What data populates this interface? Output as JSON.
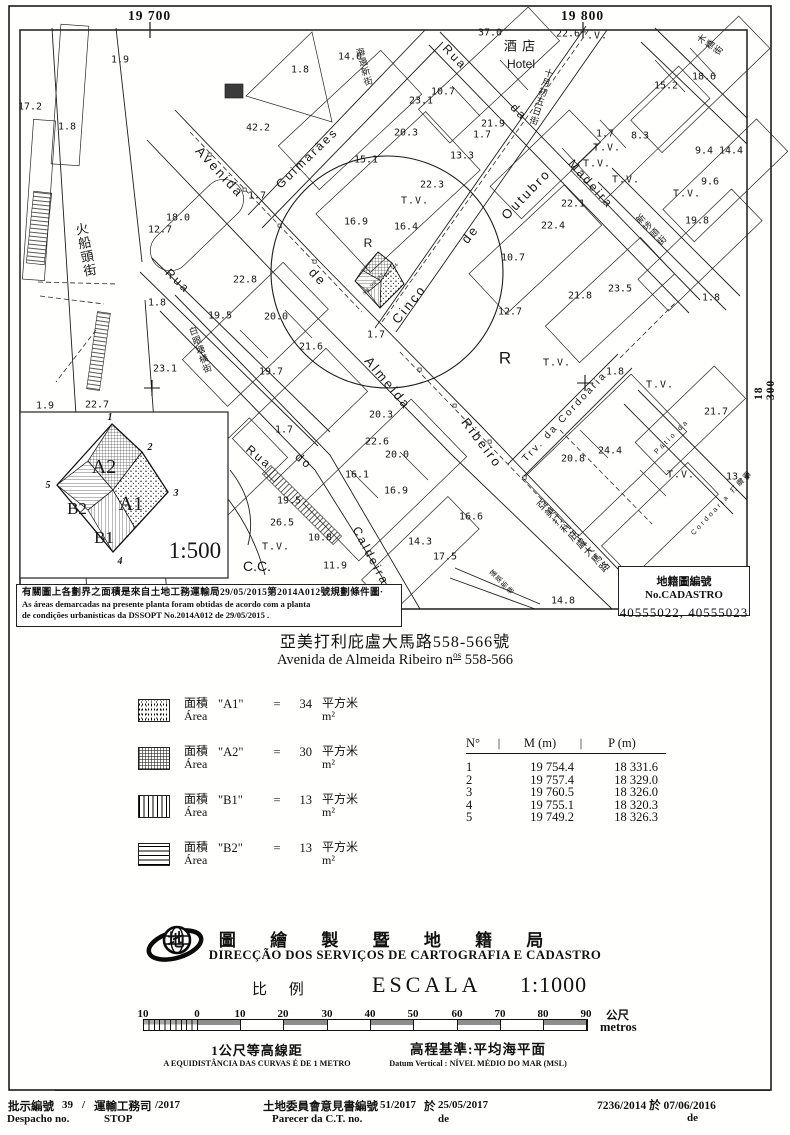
{
  "grid": {
    "top_left": "19 700",
    "top_right": "19 800",
    "right": "18 300"
  },
  "map": {
    "labels": [
      {
        "t": "Avenida",
        "x": 220,
        "y": 172,
        "r": 47,
        "s": 13,
        "k": "street"
      },
      {
        "t": "de",
        "x": 318,
        "y": 277,
        "r": 47,
        "s": 13,
        "k": "street"
      },
      {
        "t": "Almeida",
        "x": 388,
        "y": 383,
        "r": 50,
        "s": 13,
        "k": "street"
      },
      {
        "t": "Ribeiro",
        "x": 482,
        "y": 443,
        "r": 53,
        "s": 13,
        "k": "street"
      },
      {
        "t": "Cinco",
        "x": 409,
        "y": 304,
        "r": -51,
        "s": 13,
        "k": "street"
      },
      {
        "t": "de",
        "x": 470,
        "y": 234,
        "r": -51,
        "s": 13,
        "k": "street"
      },
      {
        "t": "Outubro",
        "x": 526,
        "y": 194,
        "r": -46,
        "s": 13,
        "k": "street"
      },
      {
        "t": "Guimarães",
        "x": 307,
        "y": 158,
        "r": -44,
        "s": 12,
        "k": "street"
      },
      {
        "t": "Rua",
        "x": 455,
        "y": 57,
        "r": 46,
        "s": 12,
        "k": "street"
      },
      {
        "t": "da",
        "x": 519,
        "y": 112,
        "r": 46,
        "s": 12,
        "k": "street"
      },
      {
        "t": "Madeira",
        "x": 591,
        "y": 184,
        "r": 48,
        "s": 12,
        "k": "street"
      },
      {
        "t": "Rua",
        "x": 178,
        "y": 281,
        "r": 44,
        "s": 12,
        "k": "street"
      },
      {
        "t": "Rua",
        "x": 259,
        "y": 457,
        "r": 40,
        "s": 12,
        "k": "street"
      },
      {
        "t": "do",
        "x": 304,
        "y": 461,
        "r": 40,
        "s": 12,
        "k": "street"
      },
      {
        "t": "Caldeira",
        "x": 371,
        "y": 556,
        "r": 62,
        "s": 12,
        "k": "street"
      },
      {
        "t": "Trv. da Cordoaria",
        "x": 565,
        "y": 417,
        "r": -47,
        "s": 10,
        "k": "street"
      },
      {
        "t": "Pátio da",
        "x": 672,
        "y": 437,
        "r": -45,
        "s": 7,
        "k": "street"
      },
      {
        "t": "Cordoaria 打纜圍",
        "x": 722,
        "y": 503,
        "r": -47,
        "s": 7,
        "k": "street"
      },
      {
        "t": "Hotel",
        "x": 521,
        "y": 64,
        "r": 0,
        "s": 12,
        "k": "letter"
      },
      {
        "t": "酒 店",
        "x": 520,
        "y": 46,
        "r": 0,
        "s": 13,
        "k": "cjkh"
      },
      {
        "t": "火船頭街",
        "x": 85,
        "y": 250,
        "r": -11,
        "s": 13,
        "k": "cjk",
        "v": 1
      },
      {
        "t": "海邊新街",
        "x": 364,
        "y": 67,
        "r": -15,
        "s": 9,
        "k": "cjk",
        "v": 1
      },
      {
        "t": "十月初五日街",
        "x": 541,
        "y": 97,
        "r": 17,
        "s": 9,
        "k": "cjk",
        "v": 1
      },
      {
        "t": "木橋街",
        "x": 710,
        "y": 45,
        "r": -55,
        "s": 9,
        "k": "cjk",
        "v": 1
      },
      {
        "t": "新埗頭街",
        "x": 651,
        "y": 230,
        "r": -44,
        "s": 9,
        "k": "cjk",
        "v": 1
      },
      {
        "t": "白眼塘橫街",
        "x": 200,
        "y": 350,
        "r": -20,
        "s": 9,
        "k": "cjk",
        "v": 1
      },
      {
        "t": "亞美打利庇盧大馬路",
        "x": 572,
        "y": 537,
        "r": -45,
        "s": 10,
        "k": "cjk",
        "v": 1
      },
      {
        "t": "蓬萊新巷",
        "x": 502,
        "y": 582,
        "r": -45,
        "s": 7,
        "k": "cjk",
        "v": 1
      },
      {
        "t": "R",
        "x": 368,
        "y": 243,
        "r": 0,
        "s": 12,
        "k": "letter"
      },
      {
        "t": "R",
        "x": 505,
        "y": 358,
        "r": 0,
        "s": 17,
        "k": "letter"
      },
      {
        "t": "C.C.",
        "x": 257,
        "y": 566,
        "r": 0,
        "s": 14,
        "k": "letter"
      },
      {
        "t": "T.V.",
        "x": 594,
        "y": 36,
        "k": "tv"
      },
      {
        "t": "T.V.",
        "x": 415,
        "y": 201,
        "k": "tv"
      },
      {
        "t": "T.V.",
        "x": 607,
        "y": 148,
        "k": "tv"
      },
      {
        "t": "T.V.",
        "x": 597,
        "y": 164,
        "k": "tv"
      },
      {
        "t": "T.V.",
        "x": 626,
        "y": 180,
        "k": "tv"
      },
      {
        "t": "T.V.",
        "x": 557,
        "y": 363,
        "k": "tv"
      },
      {
        "t": "T.V.",
        "x": 681,
        "y": 475,
        "k": "tv"
      },
      {
        "t": "T.V.",
        "x": 660,
        "y": 385,
        "k": "tv"
      },
      {
        "t": "T.V.",
        "x": 276,
        "y": 547,
        "k": "tv"
      },
      {
        "t": "T.V.",
        "x": 687,
        "y": 194,
        "k": "tv"
      },
      {
        "t": "1.9",
        "x": 120,
        "y": 60
      },
      {
        "t": "37.0",
        "x": 490,
        "y": 33
      },
      {
        "t": "22.6",
        "x": 568,
        "y": 34
      },
      {
        "t": "14.0",
        "x": 350,
        "y": 57
      },
      {
        "t": "1.8",
        "x": 300,
        "y": 70
      },
      {
        "t": "17.2",
        "x": 30,
        "y": 107
      },
      {
        "t": "1.8",
        "x": 67,
        "y": 127
      },
      {
        "t": "42.2",
        "x": 258,
        "y": 128
      },
      {
        "t": "10.7",
        "x": 443,
        "y": 92
      },
      {
        "t": "23.1",
        "x": 421,
        "y": 101
      },
      {
        "t": "21.9",
        "x": 493,
        "y": 124
      },
      {
        "t": "20.3",
        "x": 406,
        "y": 133
      },
      {
        "t": "15.2",
        "x": 666,
        "y": 86
      },
      {
        "t": "18.6",
        "x": 704,
        "y": 77
      },
      {
        "t": "1.7",
        "x": 482,
        "y": 135
      },
      {
        "t": "1.7",
        "x": 605,
        "y": 134
      },
      {
        "t": "8.3",
        "x": 640,
        "y": 136
      },
      {
        "t": "13.3",
        "x": 462,
        "y": 156
      },
      {
        "t": "15.1",
        "x": 366,
        "y": 160
      },
      {
        "t": "22.3",
        "x": 432,
        "y": 185
      },
      {
        "t": "16.9",
        "x": 356,
        "y": 222
      },
      {
        "t": "16.4",
        "x": 406,
        "y": 227
      },
      {
        "t": "22.1",
        "x": 573,
        "y": 204
      },
      {
        "t": "22.4",
        "x": 553,
        "y": 226
      },
      {
        "t": "10.7",
        "x": 513,
        "y": 258
      },
      {
        "t": "9.4",
        "x": 704,
        "y": 151
      },
      {
        "t": "14.4",
        "x": 731,
        "y": 151
      },
      {
        "t": "9.6",
        "x": 710,
        "y": 182
      },
      {
        "t": "19.8",
        "x": 697,
        "y": 221
      },
      {
        "t": "23.5",
        "x": 620,
        "y": 289
      },
      {
        "t": "21.8",
        "x": 580,
        "y": 296
      },
      {
        "t": "1.8",
        "x": 711,
        "y": 298
      },
      {
        "t": "18.0",
        "x": 178,
        "y": 218
      },
      {
        "t": "12.7",
        "x": 160,
        "y": 230
      },
      {
        "t": "1.7",
        "x": 257,
        "y": 196
      },
      {
        "t": "12.7",
        "x": 510,
        "y": 312
      },
      {
        "t": "1.9",
        "x": 45,
        "y": 406
      },
      {
        "t": "22.7",
        "x": 97,
        "y": 405
      },
      {
        "t": "1.8",
        "x": 157,
        "y": 303
      },
      {
        "t": "19.5",
        "x": 220,
        "y": 316
      },
      {
        "t": "20.0",
        "x": 276,
        "y": 317
      },
      {
        "t": "21.6",
        "x": 311,
        "y": 347
      },
      {
        "t": "19.7",
        "x": 271,
        "y": 372
      },
      {
        "t": "23.1",
        "x": 165,
        "y": 369
      },
      {
        "t": "22.8",
        "x": 245,
        "y": 280
      },
      {
        "t": "1.7",
        "x": 284,
        "y": 430
      },
      {
        "t": "20.3",
        "x": 381,
        "y": 415
      },
      {
        "t": "22.6",
        "x": 377,
        "y": 442
      },
      {
        "t": "20.0",
        "x": 397,
        "y": 455
      },
      {
        "t": "16.1",
        "x": 357,
        "y": 475
      },
      {
        "t": "16.9",
        "x": 396,
        "y": 491
      },
      {
        "t": "19.5",
        "x": 289,
        "y": 501
      },
      {
        "t": "26.5",
        "x": 282,
        "y": 523
      },
      {
        "t": "10.8",
        "x": 320,
        "y": 538
      },
      {
        "t": "11.9",
        "x": 335,
        "y": 566
      },
      {
        "t": "14.3",
        "x": 420,
        "y": 542
      },
      {
        "t": "17.5",
        "x": 445,
        "y": 557
      },
      {
        "t": "16.6",
        "x": 471,
        "y": 517
      },
      {
        "t": "1.8",
        "x": 615,
        "y": 372
      },
      {
        "t": "21.7",
        "x": 716,
        "y": 412
      },
      {
        "t": "24.4",
        "x": 610,
        "y": 451
      },
      {
        "t": "20.8",
        "x": 573,
        "y": 459
      },
      {
        "t": "13.4",
        "x": 738,
        "y": 477
      },
      {
        "t": "1.7",
        "x": 376,
        "y": 335
      },
      {
        "t": "14.8",
        "x": 563,
        "y": 601
      },
      {
        "t": "558 560 562",
        "x": 373,
        "y": 284,
        "r": -46,
        "s": 4.2
      },
      {
        "t": "564 566",
        "x": 391,
        "y": 270,
        "r": -46,
        "s": 4.2
      }
    ]
  },
  "inset": {
    "a2": "A2",
    "a1": "A1",
    "b2": "B2",
    "b1": "B1",
    "scale": "1:500",
    "v1": "1",
    "v2": "2",
    "v3": "3",
    "v4": "4",
    "v5": "5"
  },
  "note": {
    "cn": "有關圖上各劃界之面積是來自土地工務運輸局29/05/2015第2014A012號規劃條件圖·",
    "pt1": "As áreas demarcadas na presente planta foram obtidas de acordo com a planta",
    "pt2": "de condições urbanísticas da DSSOPT No.2014A012 de 29/05/2015 ."
  },
  "cadastro": {
    "label": "地籍圖編號 No.CADASTRO",
    "numbers": "40555022, 40555023"
  },
  "title": {
    "cn": "亞美打利庇盧大馬路558-566號",
    "pt_prefix": "Avenida de Almeida Ribeiro n",
    "pt_sup": "os",
    "pt_nums": " 558-566"
  },
  "areas": {
    "rows": [
      {
        "pattern": "a1",
        "cn": "面積",
        "pt": "Área",
        "name": "\"A1\"",
        "eq": "=",
        "value": "34",
        "unit_cn": "平方米",
        "unit_pt": "m²"
      },
      {
        "pattern": "a2",
        "cn": "面積",
        "pt": "Área",
        "name": "\"A2\"",
        "eq": "=",
        "value": "30",
        "unit_cn": "平方米",
        "unit_pt": "m²"
      },
      {
        "pattern": "b1",
        "cn": "面積",
        "pt": "Área",
        "name": "\"B1\"",
        "eq": "=",
        "value": "13",
        "unit_cn": "平方米",
        "unit_pt": "m²"
      },
      {
        "pattern": "b2",
        "cn": "面積",
        "pt": "Área",
        "name": "\"B2\"",
        "eq": "=",
        "value": "13",
        "unit_cn": "平方米",
        "unit_pt": "m²"
      }
    ]
  },
  "table": {
    "col_no": "N°",
    "sep": "|",
    "col_m": "M (m)",
    "col_p": "P (m)",
    "rows": [
      {
        "n": "1",
        "m": "19 754.4",
        "p": "18 331.6"
      },
      {
        "n": "2",
        "m": "19 757.4",
        "p": "18 329.0"
      },
      {
        "n": "3",
        "m": "19 760.5",
        "p": "18 326.0"
      },
      {
        "n": "4",
        "m": "19 755.1",
        "p": "18 320.3"
      },
      {
        "n": "5",
        "m": "19 749.2",
        "p": "18 326.3"
      }
    ]
  },
  "agency": {
    "cn": "地 圖 繪 製 暨 地 籍 局",
    "pt": "DIRECÇÃO DOS SERVIÇOS DE CARTOGRAFIA E CADASTRO",
    "scale_cn": "比 例",
    "scale_pt": "ESCALA",
    "scale_val": "1:1000"
  },
  "scalebar": {
    "ticks": [
      "10",
      "0",
      "10",
      "20",
      "30",
      "40",
      "50",
      "60",
      "70",
      "80",
      "90"
    ],
    "unit_cn": "公尺",
    "unit_pt": "metros",
    "contour_cn": "1公尺等高線距",
    "contour_pt": "A EQUIDISTÂNCIA DAS CURVAS É DE 1 METRO",
    "datum_cn": "高程基準:平均海平面",
    "datum_pt": "Datum Vertical : NÍVEL MÉDIO DO MAR (MSL)"
  },
  "footer": {
    "l1a": "批示編號",
    "l1b": "39",
    "l1c": "/",
    "l1d": "運輸工務司",
    "l1e": "/2017",
    "l2a": "Despacho no.",
    "l2b": "STOP",
    "m1a": "土地委員會意見書編號",
    "m1b": "51/2017",
    "m1c": "於",
    "m1d": "25/05/2017",
    "m2a": "Parecer da C.T. no.",
    "m2b": "de",
    "r1": "7236/2014 於 07/06/2016",
    "r2": "de"
  }
}
